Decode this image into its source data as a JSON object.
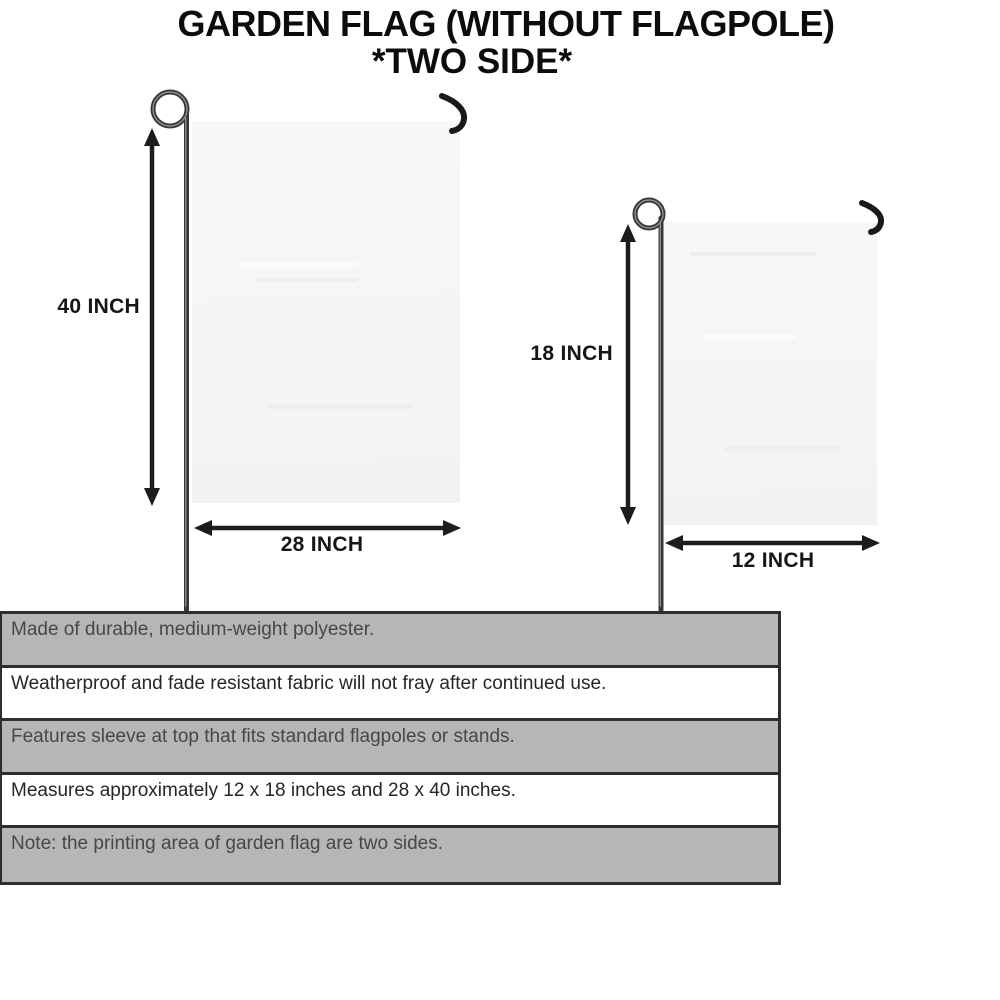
{
  "title": {
    "line1": "GARDEN FLAG (WITHOUT FLAGPOLE)",
    "line2": "*TWO SIDE*"
  },
  "diagram": {
    "large_flag": {
      "height_label": "40 INCH",
      "width_label": "28 INCH"
    },
    "small_flag": {
      "height_label": "18 INCH",
      "width_label": "12 INCH"
    }
  },
  "features": [
    "Made of durable, medium-weight polyester.",
    "Weatherproof and fade resistant fabric will not fray after continued use.",
    "Features sleeve at top that fits standard flagpoles or stands.",
    "Measures approximately 12 x 18 inches and 28 x 40 inches.",
    "Note: the printing area of garden flag are two sides."
  ],
  "colors": {
    "row_gray": "#b6b6b6",
    "row_white": "#ffffff",
    "table_border": "#2e2e2e",
    "flag_fill": "#f5f5f6",
    "pole": "#383838",
    "arrow": "#1c1c1c",
    "title_text": "#0c0c0c",
    "text_on_gray": "#474747",
    "text_on_white": "#262626"
  }
}
